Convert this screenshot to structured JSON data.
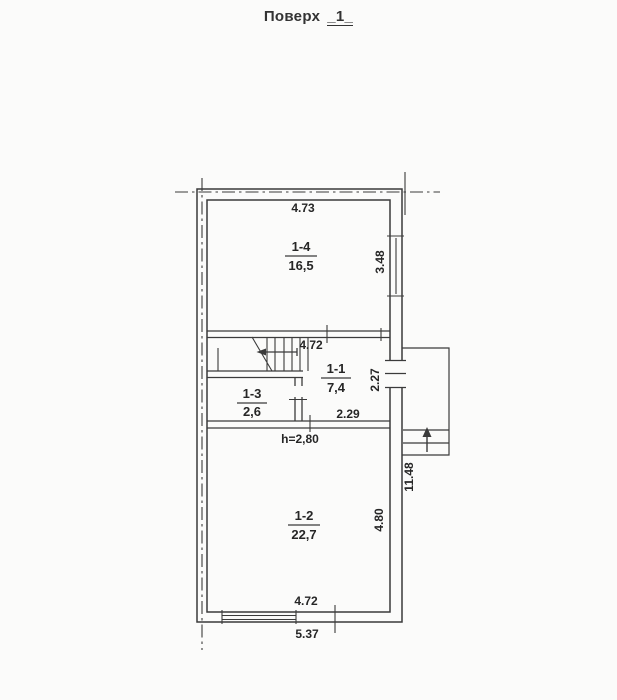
{
  "header": {
    "label": "Поверх",
    "floor": "_1_"
  },
  "rooms": {
    "r14": {
      "id": "1-4",
      "area": "16,5"
    },
    "r11": {
      "id": "1-1",
      "area": "7,4"
    },
    "r13": {
      "id": "1-3",
      "area": "2,6"
    },
    "r12": {
      "id": "1-2",
      "area": "22,7"
    }
  },
  "dimensions": {
    "top_width": "4.73",
    "room14_depth": "3.48",
    "hall_width": "4.72",
    "room11_depth": "2.27",
    "room11_width": "2.29",
    "ceiling_height": "h=2,80",
    "room12_depth": "4.80",
    "overall_height": "11.48",
    "bottom_width": "4.72",
    "overall_width": "5.37"
  },
  "colors": {
    "line": "#3b3b3b",
    "text": "#262626",
    "background": "#fbfbfa"
  }
}
